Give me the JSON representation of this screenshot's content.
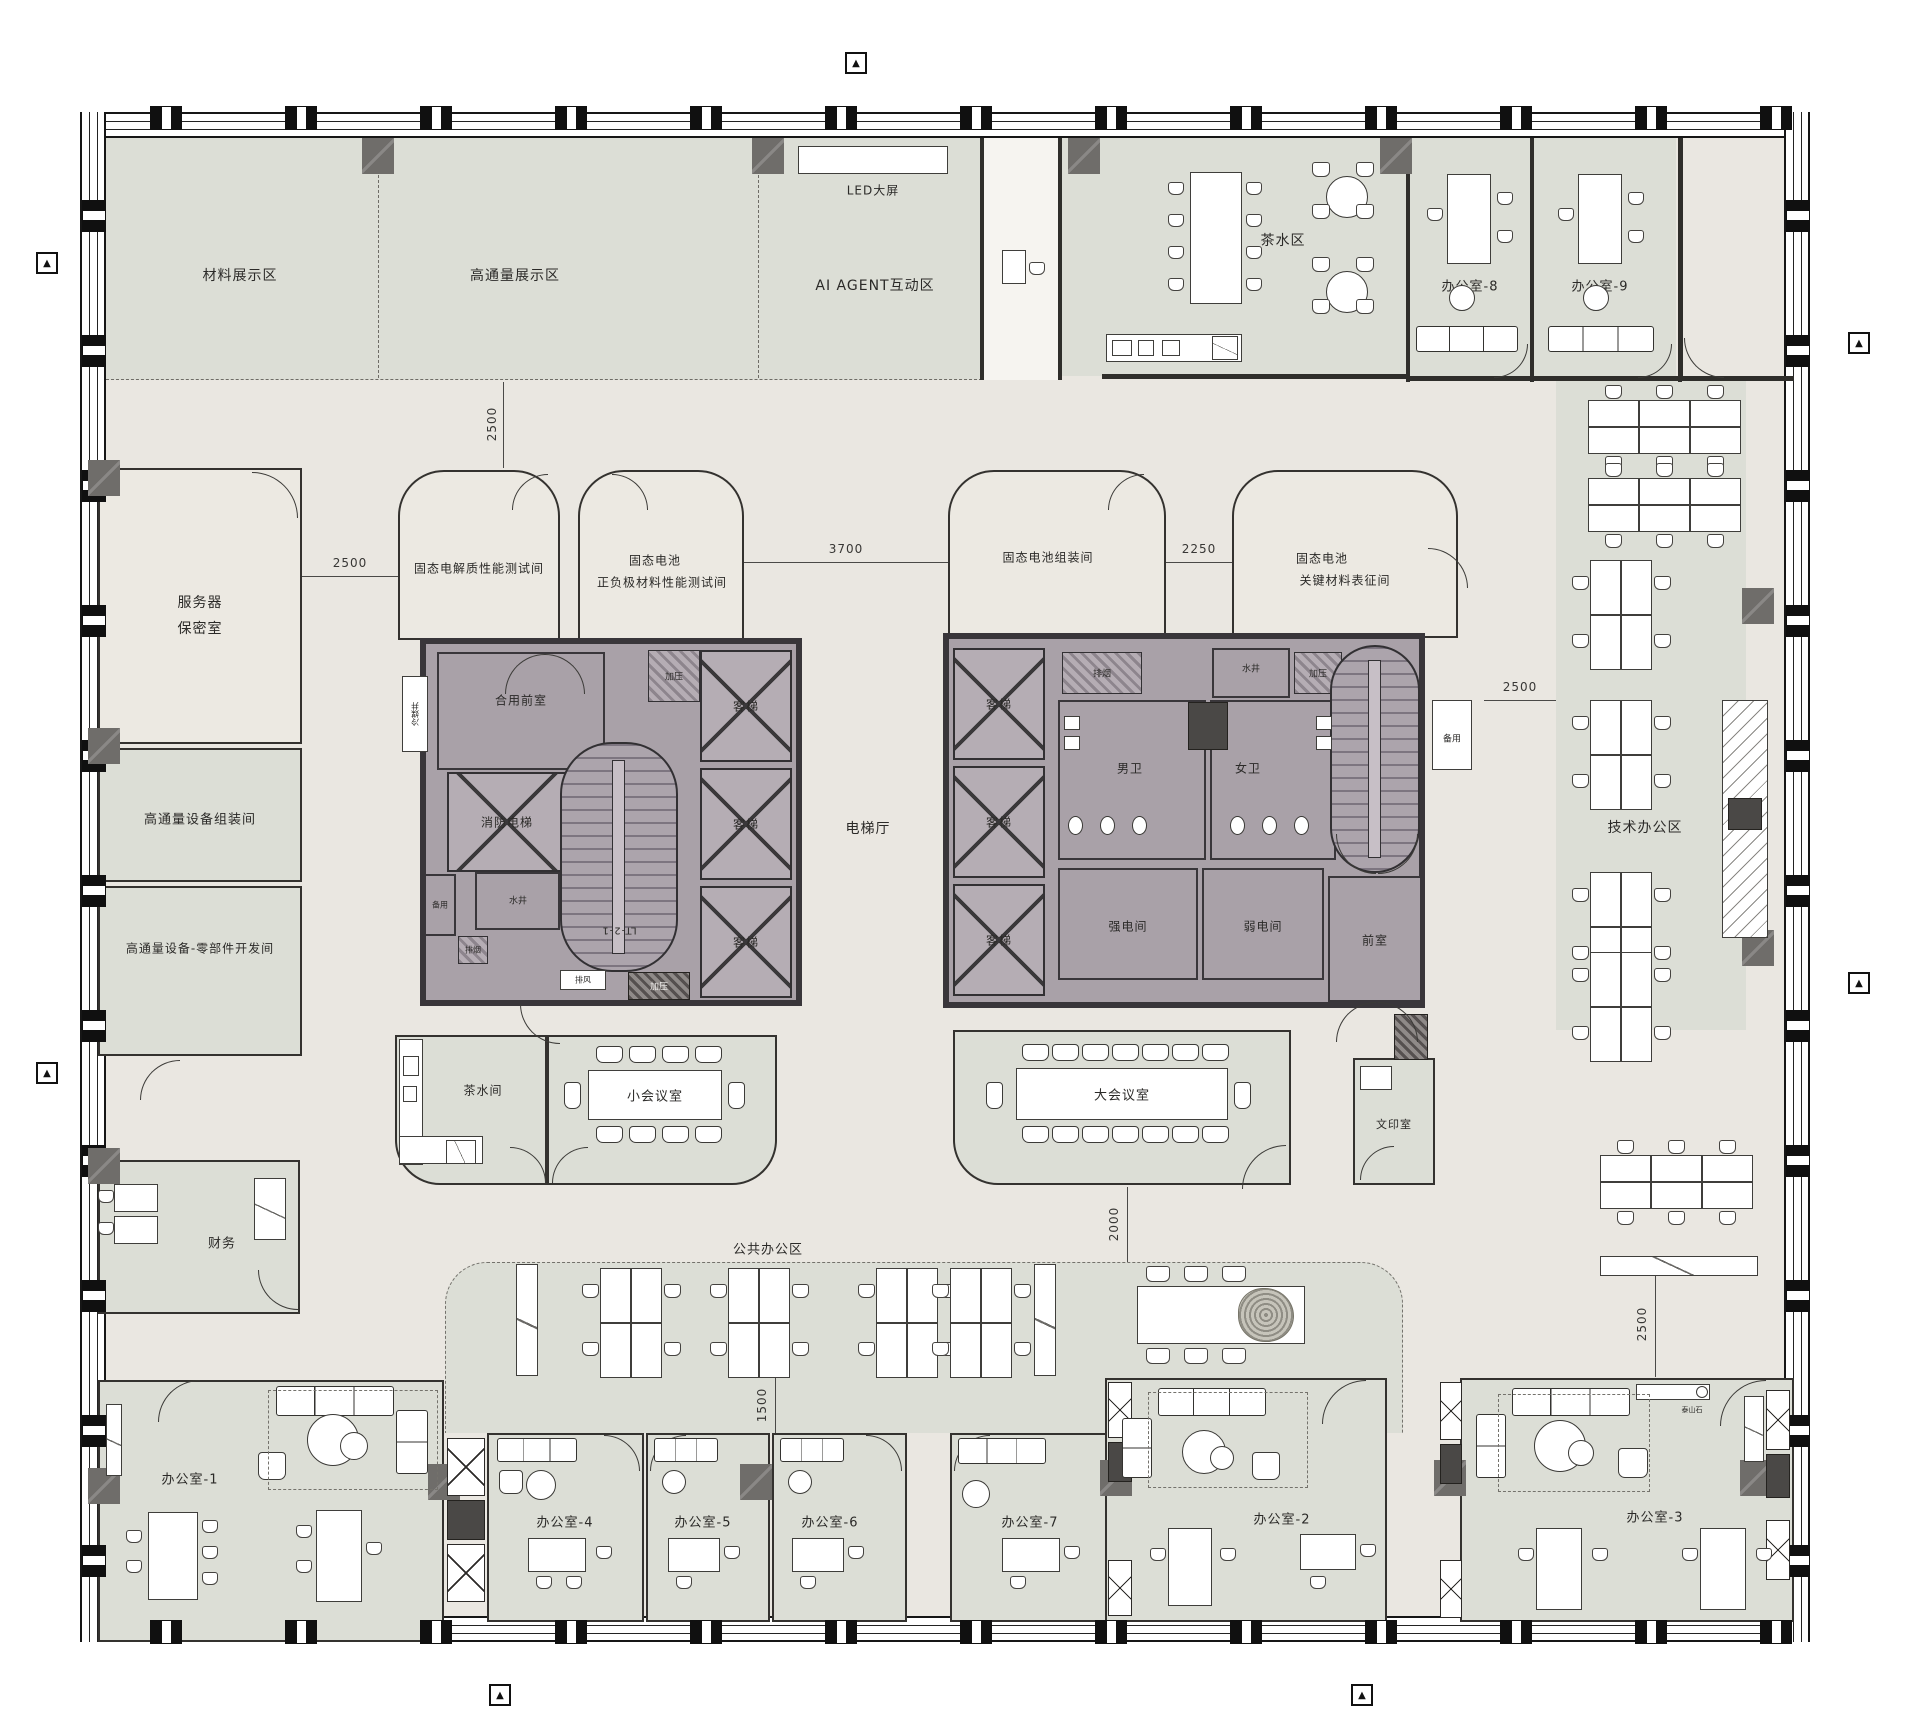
{
  "drawing": {
    "zones": {
      "material_display": "材料展示区",
      "high_throughput_display": "高通量展示区",
      "led_screen": "LED大屏",
      "ai_agent_zone": "AI AGENT互动区",
      "tea_area": "茶水区",
      "office_8": "办公室-8",
      "office_9": "办公室-9",
      "server_room_l1": "服务器",
      "server_room_l2": "保密室",
      "ht_equipment_assembly": "高通量设备组装间",
      "ht_parts_dev": "高通量设备-零部件开发间",
      "finance": "财务",
      "office_1": "办公室-1",
      "lab_electrolyte": "固态电解质性能测试间",
      "lab_electrode_l1": "固态电池",
      "lab_electrode_l2": "正负极材料性能测试间",
      "lab_pack_assembly": "固态电池组装间",
      "lab_characterization_l1": "固态电池",
      "lab_characterization_l2": "关键材料表征间",
      "elevator_hall": "电梯厅",
      "tech_office_area": "技术办公区",
      "tea_pantry": "茶水间",
      "small_meeting_room": "小会议室",
      "large_meeting_room": "大会议室",
      "print_room": "文印室",
      "public_office_area": "公共办公区",
      "office_2": "办公室-2",
      "office_3": "办公室-3",
      "office_4": "办公室-4",
      "office_5": "办公室-5",
      "office_6": "办公室-6",
      "office_7": "办公室-7"
    },
    "core": {
      "shared_front_room": "合用前室",
      "fire_elevator": "消防电梯",
      "passenger_elevator": "客梯",
      "stair_id": "LT-2-1",
      "mens_wc": "男卫",
      "womens_wc": "女卫",
      "strong_electric_room": "强电间",
      "weak_electric_room": "弱电间",
      "front_room": "前室",
      "pressurized_shaft": "加压",
      "smoke_exhaust_shaft": "排烟",
      "exhaust_shaft": "排风",
      "water_shaft": "水井",
      "spare": "备用",
      "refrigerant_shaft": "冷媒井"
    },
    "dimensions": {
      "d2500": "2500",
      "d3700": "3700",
      "d2250": "2250",
      "d2000": "2000",
      "d1500": "1500"
    },
    "annotations": {
      "fridge": "REF.",
      "taishan_stone": "泰山石",
      "section_marker": "▲"
    },
    "colors": {
      "floor": "#eae7e1",
      "zone_fill": "#dcded6",
      "lab_fill": "#ece9e2",
      "core_fill": "#a9a1a8",
      "elevator_fill": "#b5adb4",
      "wall_dark": "#2f2e2b"
    }
  }
}
